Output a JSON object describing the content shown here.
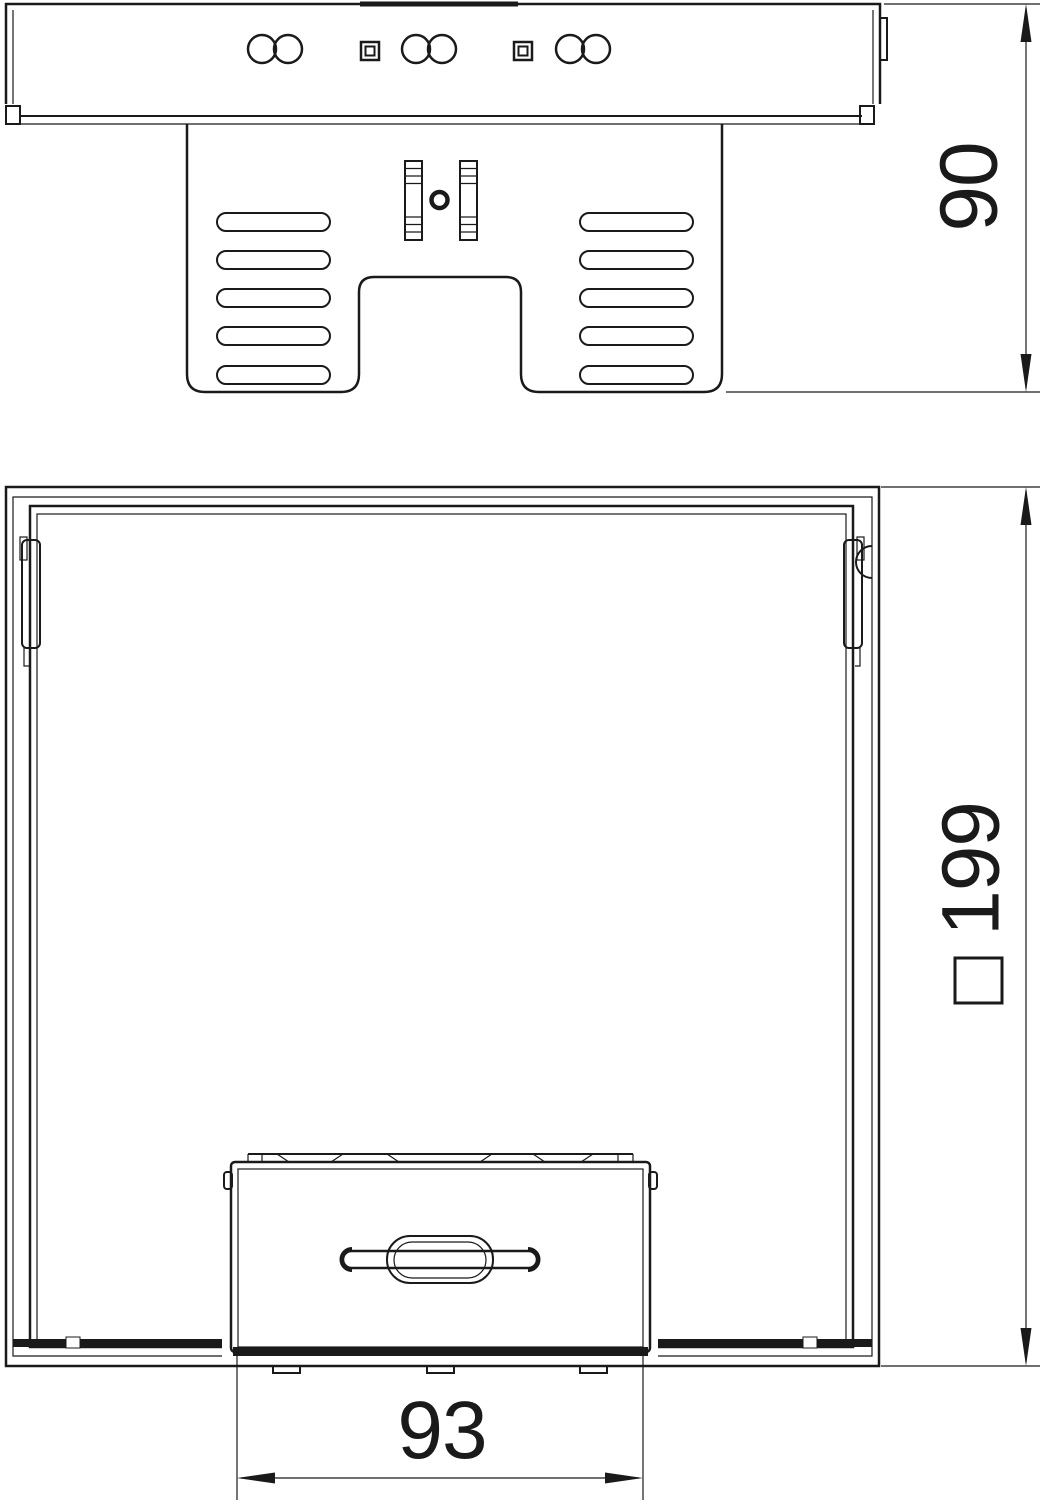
{
  "drawing": {
    "background_color": "#ffffff",
    "line_color": "#1a1a1a",
    "views": {
      "side_view": {
        "description_elements": [
          "mounting-plate",
          "ventilation-bracket",
          "hole-pairs",
          "square-holes",
          "clamp-with-screw-hole"
        ],
        "dimension_height": {
          "value": "90"
        }
      },
      "plan_view": {
        "description_elements": [
          "outer-square-housing",
          "inner-frame",
          "corner-latches",
          "cassette-drawer-with-handle",
          "mounting-tabs"
        ],
        "dimension_outer": {
          "symbol": "□",
          "value": "199"
        },
        "dimension_cassette": {
          "value": "93"
        }
      }
    }
  }
}
